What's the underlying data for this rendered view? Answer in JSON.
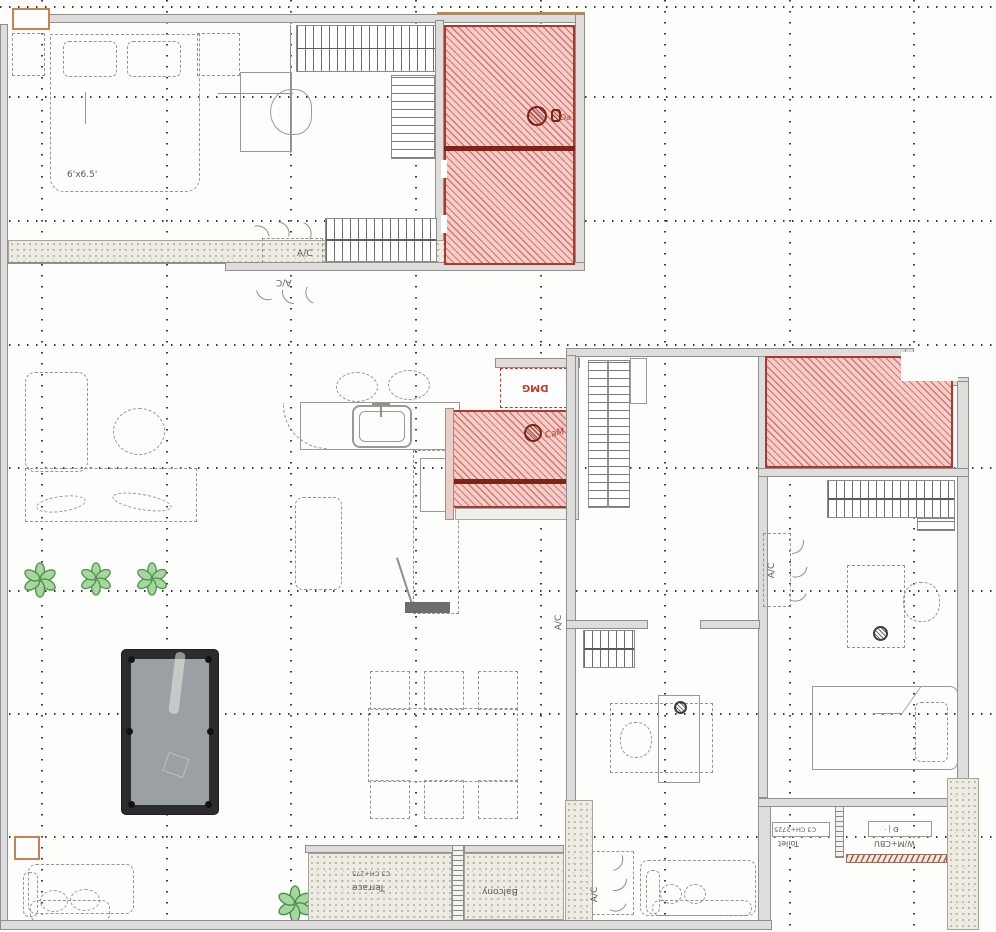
{
  "labels": {
    "bed_dim": "6'x6.5'",
    "ac": "A/C",
    "shaft": "DMG",
    "script_mid": "CaM",
    "script_top": "Da",
    "tag_ch_2725": "C3 CH+2725",
    "tag_misc": "Ð | ·",
    "room_toilet": "Toilet",
    "room_wm": "W/M+CBU",
    "terrace_tag": "C3 CH+275",
    "terrace_name": "Terrace",
    "balcony_name": "Balcony"
  },
  "icons": {
    "plant": "flower-icon",
    "airflow": "airflow-leaf-icon",
    "column": "red-column-icon"
  },
  "colors": {
    "wall_fill": "#dedddb",
    "wall_edge": "#8f8f8d",
    "red_zone_fill": "#f6cdc8",
    "red_zone_line": "#a83a30",
    "red_dark": "#7d2317",
    "tan_accent": "#c8834a",
    "stipple": "#edebe2",
    "pool_frame": "#2c2c2e",
    "pool_felt": "#9ba0a5",
    "plant_green": "#a6d79f",
    "plant_stroke": "#4c8f49",
    "grid_dot": "#3c3c3c"
  }
}
